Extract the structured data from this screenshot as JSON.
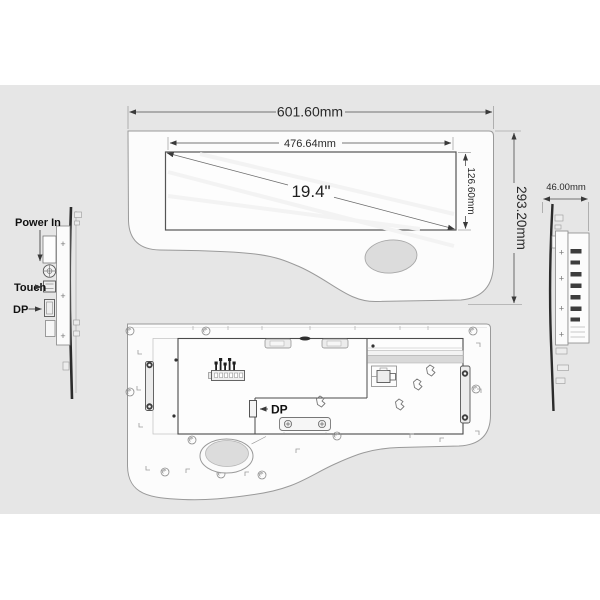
{
  "drawing": {
    "front_view": {
      "overall_width_label": "601.60mm",
      "display_width_label": "476.64mm",
      "display_height_label": "126.60mm",
      "overall_height_label": "293.20mm",
      "diagonal_label": "19.4\""
    },
    "left_side_view": {
      "power_label": "Power In",
      "touch_label": "Touch",
      "dp_label": "DP"
    },
    "right_side_view": {
      "depth_label": "46.00mm"
    },
    "back_view": {
      "dp_label": "DP"
    },
    "colors": {
      "canvas_band": "#e6e6e6",
      "panel_fill": "#fcfcfc",
      "outline": "#9a9a9a",
      "bold_line": "#4a4a4a",
      "dimension_line": "#4a4a4a",
      "text": "#1f1f1f",
      "cutout_fill": "#dcdcdc",
      "connector_dark": "#3d3d3d"
    }
  }
}
